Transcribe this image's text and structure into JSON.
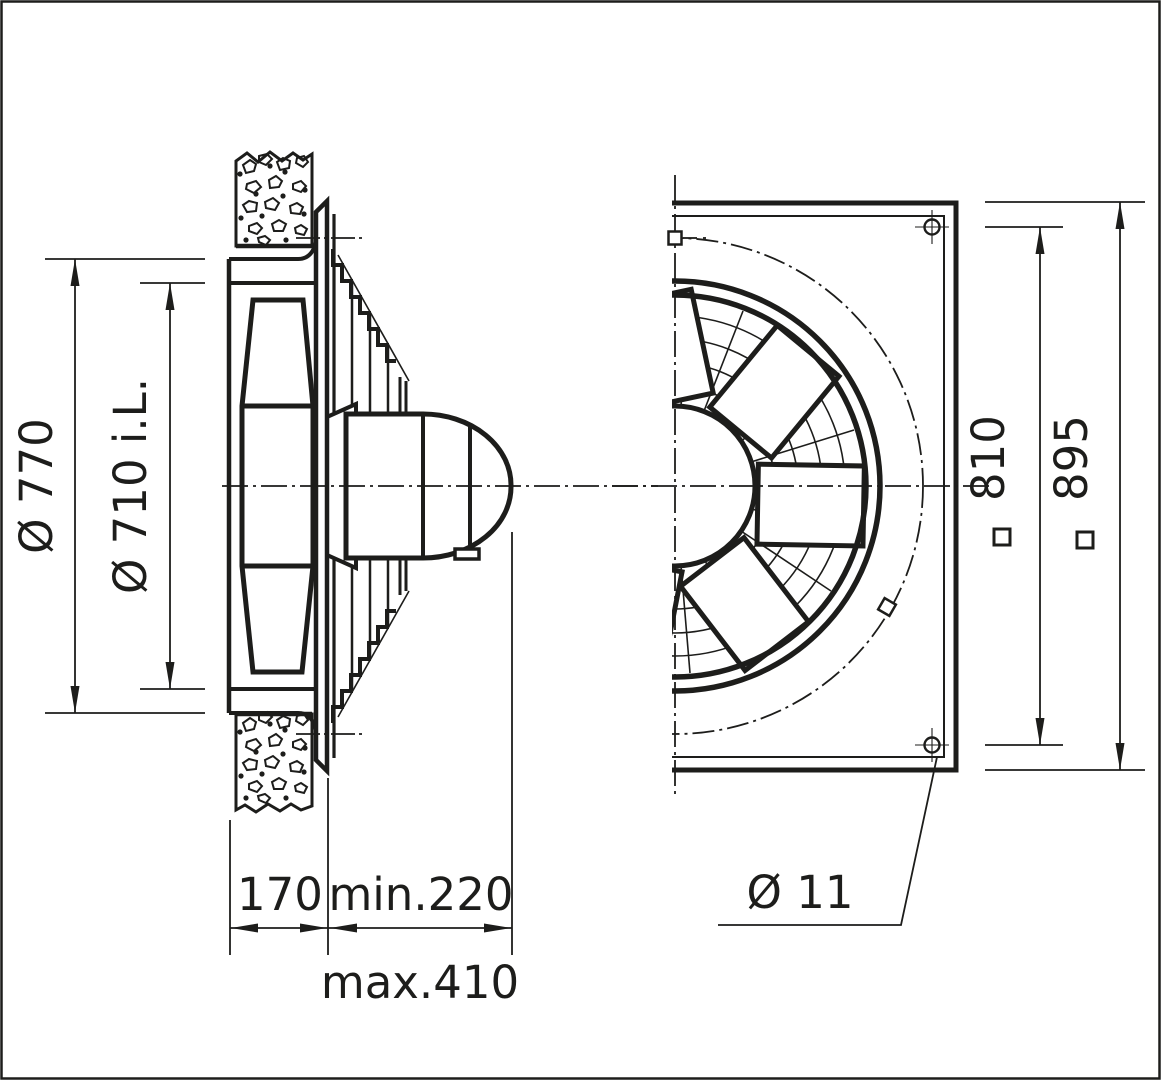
{
  "side_view": {
    "outer_diameter": "Ø 770",
    "inner_diameter": "Ø 710 i.L.",
    "wall_depth": "170",
    "min_clearance": "min.220",
    "max_depth": "max.410"
  },
  "front_view": {
    "bolt_spacing": "810",
    "plate_size": "895",
    "bolt_hole_diameter": "Ø 11"
  },
  "colors": {
    "line": "#1d1d1b",
    "background": "#ffffff"
  }
}
